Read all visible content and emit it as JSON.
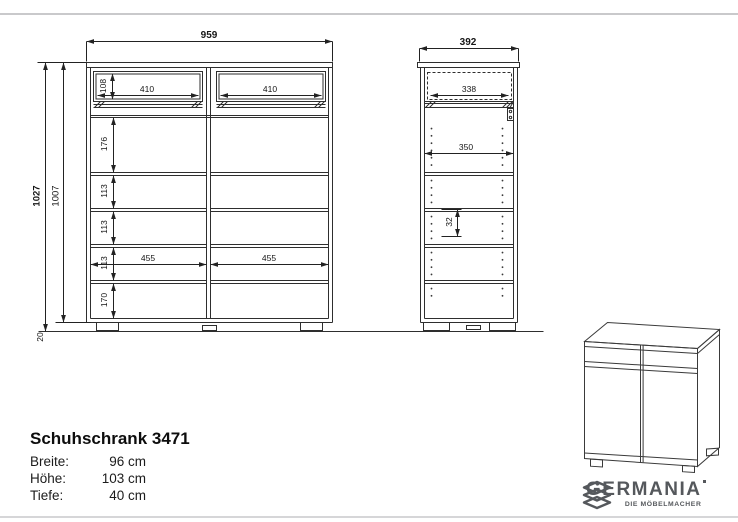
{
  "product": {
    "title": "Schuhschrank 3471",
    "specs": [
      {
        "label": "Breite:",
        "value": "96 cm"
      },
      {
        "label": "Höhe:",
        "value": "103 cm"
      },
      {
        "label": "Tiefe:",
        "value": "40 cm"
      }
    ]
  },
  "brand": {
    "name": "GERMANIA",
    "tagline": "DIE MÖBELMACHER",
    "color": "#55585c",
    "logo_icon": "stacked-layers-icon"
  },
  "dims": {
    "front": {
      "width": "959",
      "height_total": "1027",
      "height_carcass": "1007",
      "plinth": "20",
      "drawer_h": "108",
      "drawer_w_left": "410",
      "drawer_w_right": "410",
      "comp1": "176",
      "comp2": "113",
      "comp3": "113",
      "comp4": "113",
      "comp5": "170",
      "bay_left": "455",
      "bay_right": "455"
    },
    "side": {
      "depth": "392",
      "drawer_d": "338",
      "shelf_d": "350",
      "pitch": "32"
    }
  }
}
